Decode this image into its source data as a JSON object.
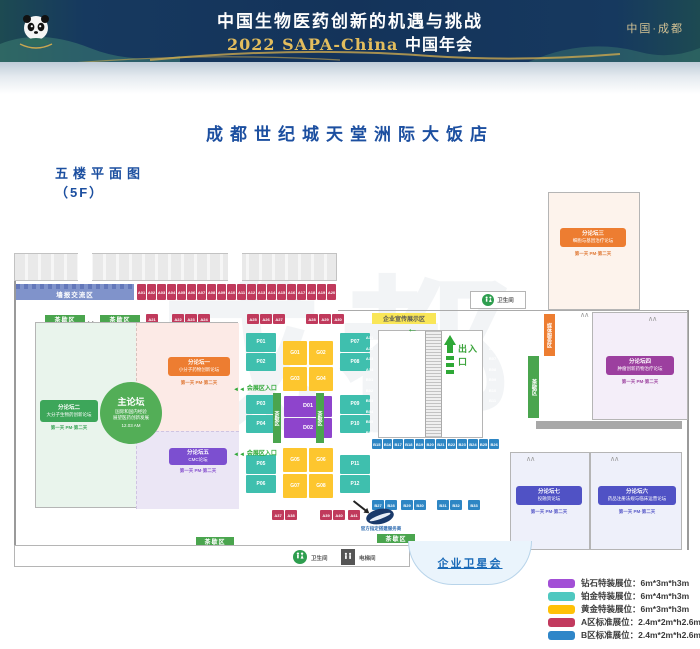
{
  "banner": {
    "title": "中国生物医药创新的机遇与挑战",
    "subtitle_year": "2022 SAPA-China",
    "subtitle_cn": "中国年会",
    "location": "中国·成都"
  },
  "page": {
    "hotel_title": "成都世纪城天堂洲际大饭店",
    "floor_label": "五楼平面图",
    "floor_code": "（5F）",
    "watermark": "成都"
  },
  "plan": {
    "poster_area": "墙报交流区",
    "tea_break": "茶歇区",
    "promo_area": "企业宣传展示区",
    "exit_label": "出入口",
    "expo_entrance": "会展区入口",
    "restroom": "卫生间",
    "elevator": "电梯间",
    "media_service": "媒体服务区",
    "satellite": "企业卫星会",
    "contractor_caption": "官方指定搭建服务商",
    "main_forum": {
      "title": "主论坛",
      "line1": "国际和国内经验",
      "line2": "展望医药创新发展",
      "time": "12.03 AM"
    },
    "forums": [
      {
        "title": "分论坛一",
        "name": "小分子药物创新论坛",
        "schedule": "第一天 PM·第二天"
      },
      {
        "title": "分论坛二",
        "name": "大分子生物药创新论坛",
        "schedule": "第一天 PM·第二天"
      },
      {
        "title": "分论坛三",
        "name": "细胞与基因治疗论坛",
        "schedule": "第一天 PM·第二天"
      },
      {
        "title": "分论坛四",
        "name": "肿瘤创新药物治疗论坛",
        "schedule": "第一天 PM·第二天"
      },
      {
        "title": "分论坛五",
        "name": "CMC论坛",
        "schedule": "第一天 PM·第二天"
      },
      {
        "title": "分论坛六",
        "name": "药品注册法规与临床运营论坛",
        "schedule": "第一天 PM·第二天"
      },
      {
        "title": "分论坛七",
        "name": "投融资论坛",
        "schedule": "第一天 PM·第二天"
      }
    ],
    "booths": {
      "top_row": [
        "A01",
        "A02",
        "A03",
        "A04",
        "A05",
        "A06",
        "A07",
        "A08",
        "A09",
        "A10",
        "A11",
        "A12",
        "A13",
        "A14",
        "A15",
        "A16",
        "A17",
        "A18",
        "A19",
        "A20"
      ],
      "mini_single": [
        "A21"
      ],
      "mini_a": [
        "A22",
        "A23",
        "A24"
      ],
      "mini_b": [
        "A25",
        "A26",
        "A27"
      ],
      "mini_c": [
        "A28",
        "A29",
        "A30"
      ],
      "esc_left": [
        "A31",
        "A32",
        "A33",
        "A34",
        "B01",
        "B02",
        "B03",
        "B04",
        "B05",
        "B06"
      ],
      "esc_right": [
        "A35",
        "A36",
        "B07",
        "B08",
        "B09",
        "B10",
        "B11",
        "B12",
        "B13",
        "B14"
      ],
      "esc_bottom": [
        "B15",
        "B16",
        "B17",
        "B18",
        "B19",
        "B20",
        "B21",
        "B22",
        "B23",
        "B24",
        "B25",
        "B26"
      ],
      "blue_a": [
        "B27",
        "B28"
      ],
      "blue_b": [
        "B29",
        "B30"
      ],
      "blue_c": [
        "B31",
        "B32"
      ],
      "blue_d": [
        "B33"
      ],
      "red_a": [
        "A37",
        "A38"
      ],
      "red_b": [
        "A39",
        "A40"
      ],
      "red_c": [
        "A41"
      ],
      "teal_l1": [
        "P01",
        "P02"
      ],
      "teal_l2": [
        "P03",
        "P04"
      ],
      "teal_l3": [
        "P05",
        "P06"
      ],
      "teal_r1": [
        "P07",
        "P08"
      ],
      "teal_r2": [
        "P09",
        "P10"
      ],
      "teal_r3": [
        "P11",
        "P12"
      ],
      "gold_1": [
        "G01",
        "G02",
        "G03",
        "G04"
      ],
      "gold_2": [
        "G05",
        "G06",
        "G07",
        "G08"
      ],
      "diamond": [
        "D01",
        "D02"
      ]
    }
  },
  "legend": {
    "items": [
      {
        "color": "#a24fd6",
        "label": "钻石特装展位：6m*3m*h3m"
      },
      {
        "color": "#4fc8c0",
        "label": "铂金特装展位：6m*4m*h3m"
      },
      {
        "color": "#ffc107",
        "label": "黄金特装展位：6m*3m*h3m"
      },
      {
        "color": "#c23a5e",
        "label": "A区标准展位：2.4m*2m*h2.6m"
      },
      {
        "color": "#2f86c8",
        "label": "B区标准展位：2.4m*2m*h2.6m"
      }
    ]
  }
}
